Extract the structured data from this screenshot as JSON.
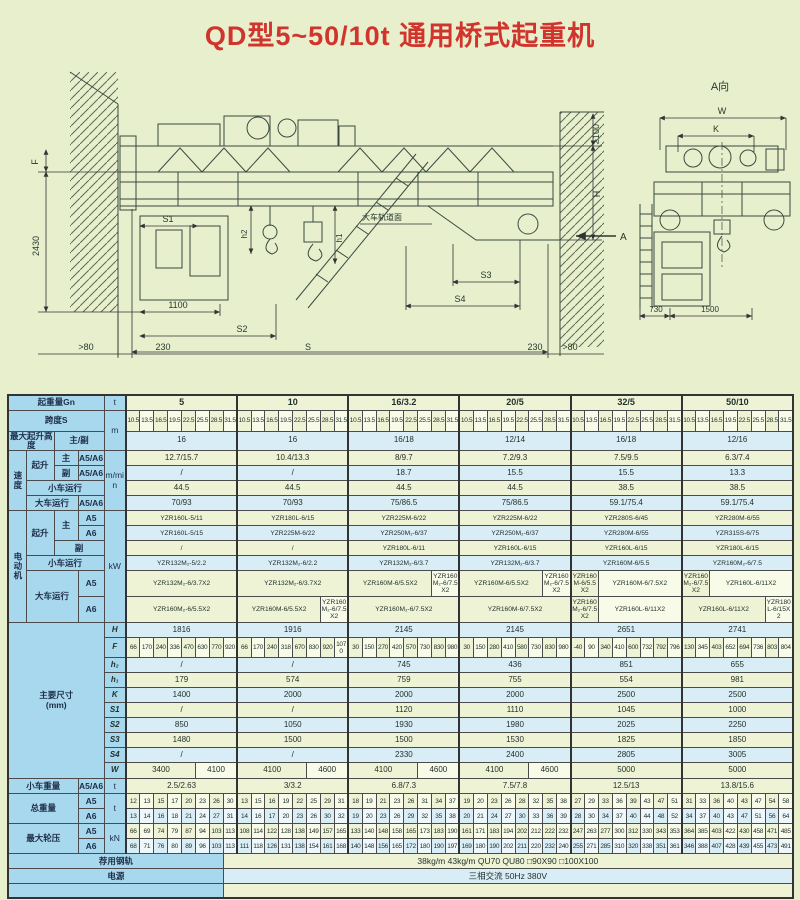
{
  "title": "QD型5~50/10t 通用桥式起重机",
  "colors": {
    "accent_red": "#d0342c",
    "label_blue": "#a8d8ee",
    "row_cream": "#eff3d6",
    "row_blue": "#d9edf7",
    "page_bg": "#e7efcd"
  },
  "drawing": {
    "view_label": "A向",
    "dim_w": "W",
    "dim_k": "K",
    "dim_730": "730",
    "dim_1500": "1500",
    "dim_f": "F",
    "dim_2430": "2430",
    "dim_s1": "S1",
    "dim_1100": "1100",
    "dim_s2": "S2",
    "dim_gt80_l": ">80",
    "dim_230_l": "230",
    "dim_s": "S",
    "dim_230_r": "230",
    "dim_gt80_r": ">80",
    "dim_ge100": "≥100",
    "dim_h": "H",
    "dim_s3": "S3",
    "dim_s4": "S4",
    "dim_h1": "h1",
    "dim_h2": "h2",
    "rail_surface": "大车轨道面",
    "arrow_a": "A"
  },
  "table": {
    "labels": {
      "capacity": "起重量Gn",
      "span": "跨度S",
      "lift_height": "最大起升高度",
      "main_aux": "主/副",
      "speed": "速度",
      "hoist": "起升",
      "main": "主",
      "aux": "副",
      "a5a6": "A5/A6",
      "a5": "A5",
      "a6": "A6",
      "trolley_travel": "小车运行",
      "crane_travel": "大车运行",
      "motor": "电动机",
      "dims": "主要尺寸\n(mm)",
      "trolley_weight": "小车重量",
      "total_weight": "总重量",
      "wheel_load": "最大轮压",
      "rail": "荐用钢轨",
      "power": "电源"
    },
    "units": {
      "t": "t",
      "m": "m",
      "mmin": "m/min",
      "kw": "kW",
      "kn": "kN"
    },
    "dim_row_labels": {
      "H": "H",
      "F": "F",
      "h2": "h₂",
      "h1": "h₁",
      "K": "K",
      "S1": "S1",
      "S2": "S2",
      "S3": "S3",
      "S4": "S4",
      "W": "W"
    },
    "capacities": [
      "5",
      "10",
      "16/3.2",
      "20/5",
      "32/5",
      "50/10"
    ],
    "spans": [
      "10.5",
      "13.5",
      "16.5",
      "19.5",
      "22.5",
      "25.5",
      "28.5",
      "31.5"
    ],
    "rows": {
      "lift_height": [
        "16",
        "16",
        "16/18",
        "12/14",
        "16/18",
        "12/16"
      ],
      "hoist_main_speed": [
        "12.7/15.7",
        "10.4/13.3",
        "8/9.7",
        "7.2/9.3",
        "7.5/9.5",
        "6.3/7.4"
      ],
      "hoist_aux_speed": [
        "/",
        "/",
        "18.7",
        "15.5",
        "15.5",
        "13.3"
      ],
      "trolley_speed": [
        "44.5",
        "44.5",
        "44.5",
        "44.5",
        "38.5",
        "38.5"
      ],
      "crane_speed": [
        "70/93",
        "70/93",
        "75/86.5",
        "75/86.5",
        "59.1/75.4",
        "59.1/75.4"
      ],
      "motor_main_a5": [
        "YZR160L-5/11",
        "YZR180L-6/15",
        "YZR225M-6/22",
        "YZR225M-6/22",
        "YZR280S-6/45",
        "YZR280M-6/55"
      ],
      "motor_main_a6": [
        "YZR160L-5/15",
        "YZR225M-6/22",
        "YZR250M₁-6/37",
        "YZR250M₂-6/37",
        "YZR280M-6/55",
        "YZR315S-6/75"
      ],
      "motor_aux": [
        "/",
        "/",
        "YZR180L-6/11",
        "YZR160L-6/15",
        "YZR160L-6/15",
        "YZR180L-6/15"
      ],
      "motor_trolley": [
        "YZR132M₂-5/2.2",
        "YZR132M₂-6/2.2",
        "YZR132M₂-6/3.7",
        "YZR132M₂-6/3.7",
        "YZR160M-6/5.5",
        "YZR160M₂-6/7.5"
      ],
      "motor_crane_a5": [
        [
          {
            "t": "YZR132M₂-6/3.7X2",
            "c": 8
          }
        ],
        [
          {
            "t": "YZR132M₂-6/3.7X2",
            "c": 8
          }
        ],
        [
          {
            "t": "YZR160M-6/5.5X2",
            "c": 6
          },
          {
            "t": "YZR160M₂-6/7.5X2",
            "c": 2
          }
        ],
        [
          {
            "t": "YZR160M-6/5.5X2",
            "c": 6
          },
          {
            "t": "YZR160M₂-6/7.5X2",
            "c": 2
          }
        ],
        [
          {
            "t": "YZR160M-6/5.5X2",
            "c": 2
          },
          {
            "t": "YZR160M-6/7.5X2",
            "c": 6
          }
        ],
        [
          {
            "t": "YZR160M₂-6/7.5X2",
            "c": 2
          },
          {
            "t": "YZR160L-6/11X2",
            "c": 6
          }
        ]
      ],
      "motor_crane_a6": [
        [
          {
            "t": "YZR160M₂-6/5.5X2",
            "c": 8
          }
        ],
        [
          {
            "t": "YZR160M-6/5.5X2",
            "c": 6
          },
          {
            "t": "YZR160M₂-6/7.5X2",
            "c": 2
          }
        ],
        [
          {
            "t": "YZR160M₂-6/7.5X2",
            "c": 8
          }
        ],
        [
          {
            "t": "YZR160M-6/7.5X2",
            "c": 8
          }
        ],
        [
          {
            "t": "YZR160M₂-6/7.5X2",
            "c": 2
          },
          {
            "t": "YZR160L-6/11X2",
            "c": 6
          }
        ],
        [
          {
            "t": "YZR160L-6/11X2",
            "c": 6
          },
          {
            "t": "YZR180L-6/15X2",
            "c": 2
          }
        ]
      ],
      "H": [
        "1816",
        "1916",
        "2145",
        "2145",
        "2651",
        "2741"
      ],
      "F": [
        [
          "66",
          "170",
          "240",
          "336",
          "470",
          "630",
          "770",
          "920"
        ],
        [
          "66",
          "170",
          "240",
          "318",
          "670",
          "830",
          "920",
          "1070"
        ],
        [
          "30",
          "150",
          "270",
          "420",
          "570",
          "730",
          "830",
          "980"
        ],
        [
          "30",
          "150",
          "280",
          "410",
          "580",
          "730",
          "830",
          "980"
        ],
        [
          "-40",
          "90",
          "340",
          "410",
          "600",
          "732",
          "792",
          "796"
        ],
        [
          "130",
          "345",
          "403",
          "652",
          "694",
          "736",
          "803",
          "804"
        ]
      ],
      "h2": [
        "/",
        "/",
        "745",
        "436",
        "851",
        "655"
      ],
      "h1": [
        "179",
        "574",
        "759",
        "755",
        "554",
        "981"
      ],
      "K": [
        "1400",
        "2000",
        "2000",
        "2000",
        "2500",
        "2500"
      ],
      "S1": [
        "/",
        "/",
        "1120",
        "1110",
        "1045",
        "1000"
      ],
      "S2": [
        "850",
        "1050",
        "1930",
        "1980",
        "2025",
        "2250"
      ],
      "S3": [
        "1480",
        "1500",
        "1500",
        "1530",
        "1825",
        "1850"
      ],
      "S4": [
        "/",
        "/",
        "2330",
        "2400",
        "2805",
        "3005"
      ],
      "W": [
        [
          {
            "t": "3400",
            "c": 5
          },
          {
            "t": "4100",
            "c": 3
          }
        ],
        [
          {
            "t": "4100",
            "c": 5
          },
          {
            "t": "4600",
            "c": 3
          }
        ],
        [
          {
            "t": "4100",
            "c": 5
          },
          {
            "t": "4600",
            "c": 3
          }
        ],
        [
          {
            "t": "4100",
            "c": 5
          },
          {
            "t": "4600",
            "c": 3
          }
        ],
        [
          {
            "t": "5000",
            "c": 8
          }
        ],
        [
          {
            "t": "5000",
            "c": 8
          }
        ]
      ],
      "trolley_weight": [
        "2.5/2.63",
        "3/3.2",
        "6.8/7.3",
        "7.5/7.8",
        "12.5/13",
        "13.8/15.6"
      ],
      "total_weight_a5": [
        [
          "12",
          "13",
          "15",
          "17",
          "20",
          "23",
          "26",
          "30"
        ],
        [
          "13",
          "15",
          "16",
          "19",
          "22",
          "25",
          "29",
          "31"
        ],
        [
          "18",
          "19",
          "21",
          "23",
          "26",
          "31",
          "34",
          "37"
        ],
        [
          "19",
          "20",
          "23",
          "26",
          "28",
          "32",
          "35",
          "38"
        ],
        [
          "27",
          "29",
          "33",
          "36",
          "39",
          "43",
          "47",
          "51"
        ],
        [
          "31",
          "33",
          "36",
          "40",
          "43",
          "47",
          "54",
          "58"
        ]
      ],
      "total_weight_a6": [
        [
          "13",
          "14",
          "16",
          "18",
          "21",
          "24",
          "27",
          "31"
        ],
        [
          "14",
          "16",
          "17",
          "20",
          "23",
          "26",
          "30",
          "32"
        ],
        [
          "19",
          "20",
          "23",
          "26",
          "29",
          "32",
          "35",
          "38"
        ],
        [
          "20",
          "21",
          "24",
          "27",
          "30",
          "33",
          "36",
          "39"
        ],
        [
          "28",
          "30",
          "34",
          "37",
          "40",
          "44",
          "48",
          "52"
        ],
        [
          "34",
          "37",
          "40",
          "43",
          "47",
          "51",
          "56",
          "64"
        ]
      ],
      "wheel_load_a5": [
        [
          "66",
          "69",
          "74",
          "79",
          "87",
          "94",
          "103",
          "113"
        ],
        [
          "108",
          "114",
          "122",
          "128",
          "138",
          "149",
          "157",
          "165"
        ],
        [
          "133",
          "140",
          "148",
          "158",
          "165",
          "173",
          "183",
          "190"
        ],
        [
          "161",
          "171",
          "183",
          "194",
          "202",
          "212",
          "222",
          "232"
        ],
        [
          "247",
          "263",
          "277",
          "300",
          "312",
          "330",
          "343",
          "353"
        ],
        [
          "364",
          "385",
          "403",
          "422",
          "430",
          "458",
          "471",
          "485"
        ]
      ],
      "wheel_load_a6": [
        [
          "68",
          "71",
          "76",
          "80",
          "89",
          "96",
          "103",
          "113"
        ],
        [
          "111",
          "118",
          "126",
          "131",
          "138",
          "154",
          "161",
          "168"
        ],
        [
          "140",
          "148",
          "156",
          "165",
          "172",
          "180",
          "190",
          "197"
        ],
        [
          "169",
          "180",
          "190",
          "202",
          "211",
          "220",
          "232",
          "240"
        ],
        [
          "255",
          "271",
          "285",
          "310",
          "320",
          "338",
          "351",
          "361"
        ],
        [
          "346",
          "388",
          "407",
          "428",
          "439",
          "455",
          "473",
          "491"
        ]
      ],
      "rail": "38kg/m  43kg/m  QU70   QU80   □90X90   □100X100",
      "power": "三相交流  50Hz  380V"
    }
  }
}
